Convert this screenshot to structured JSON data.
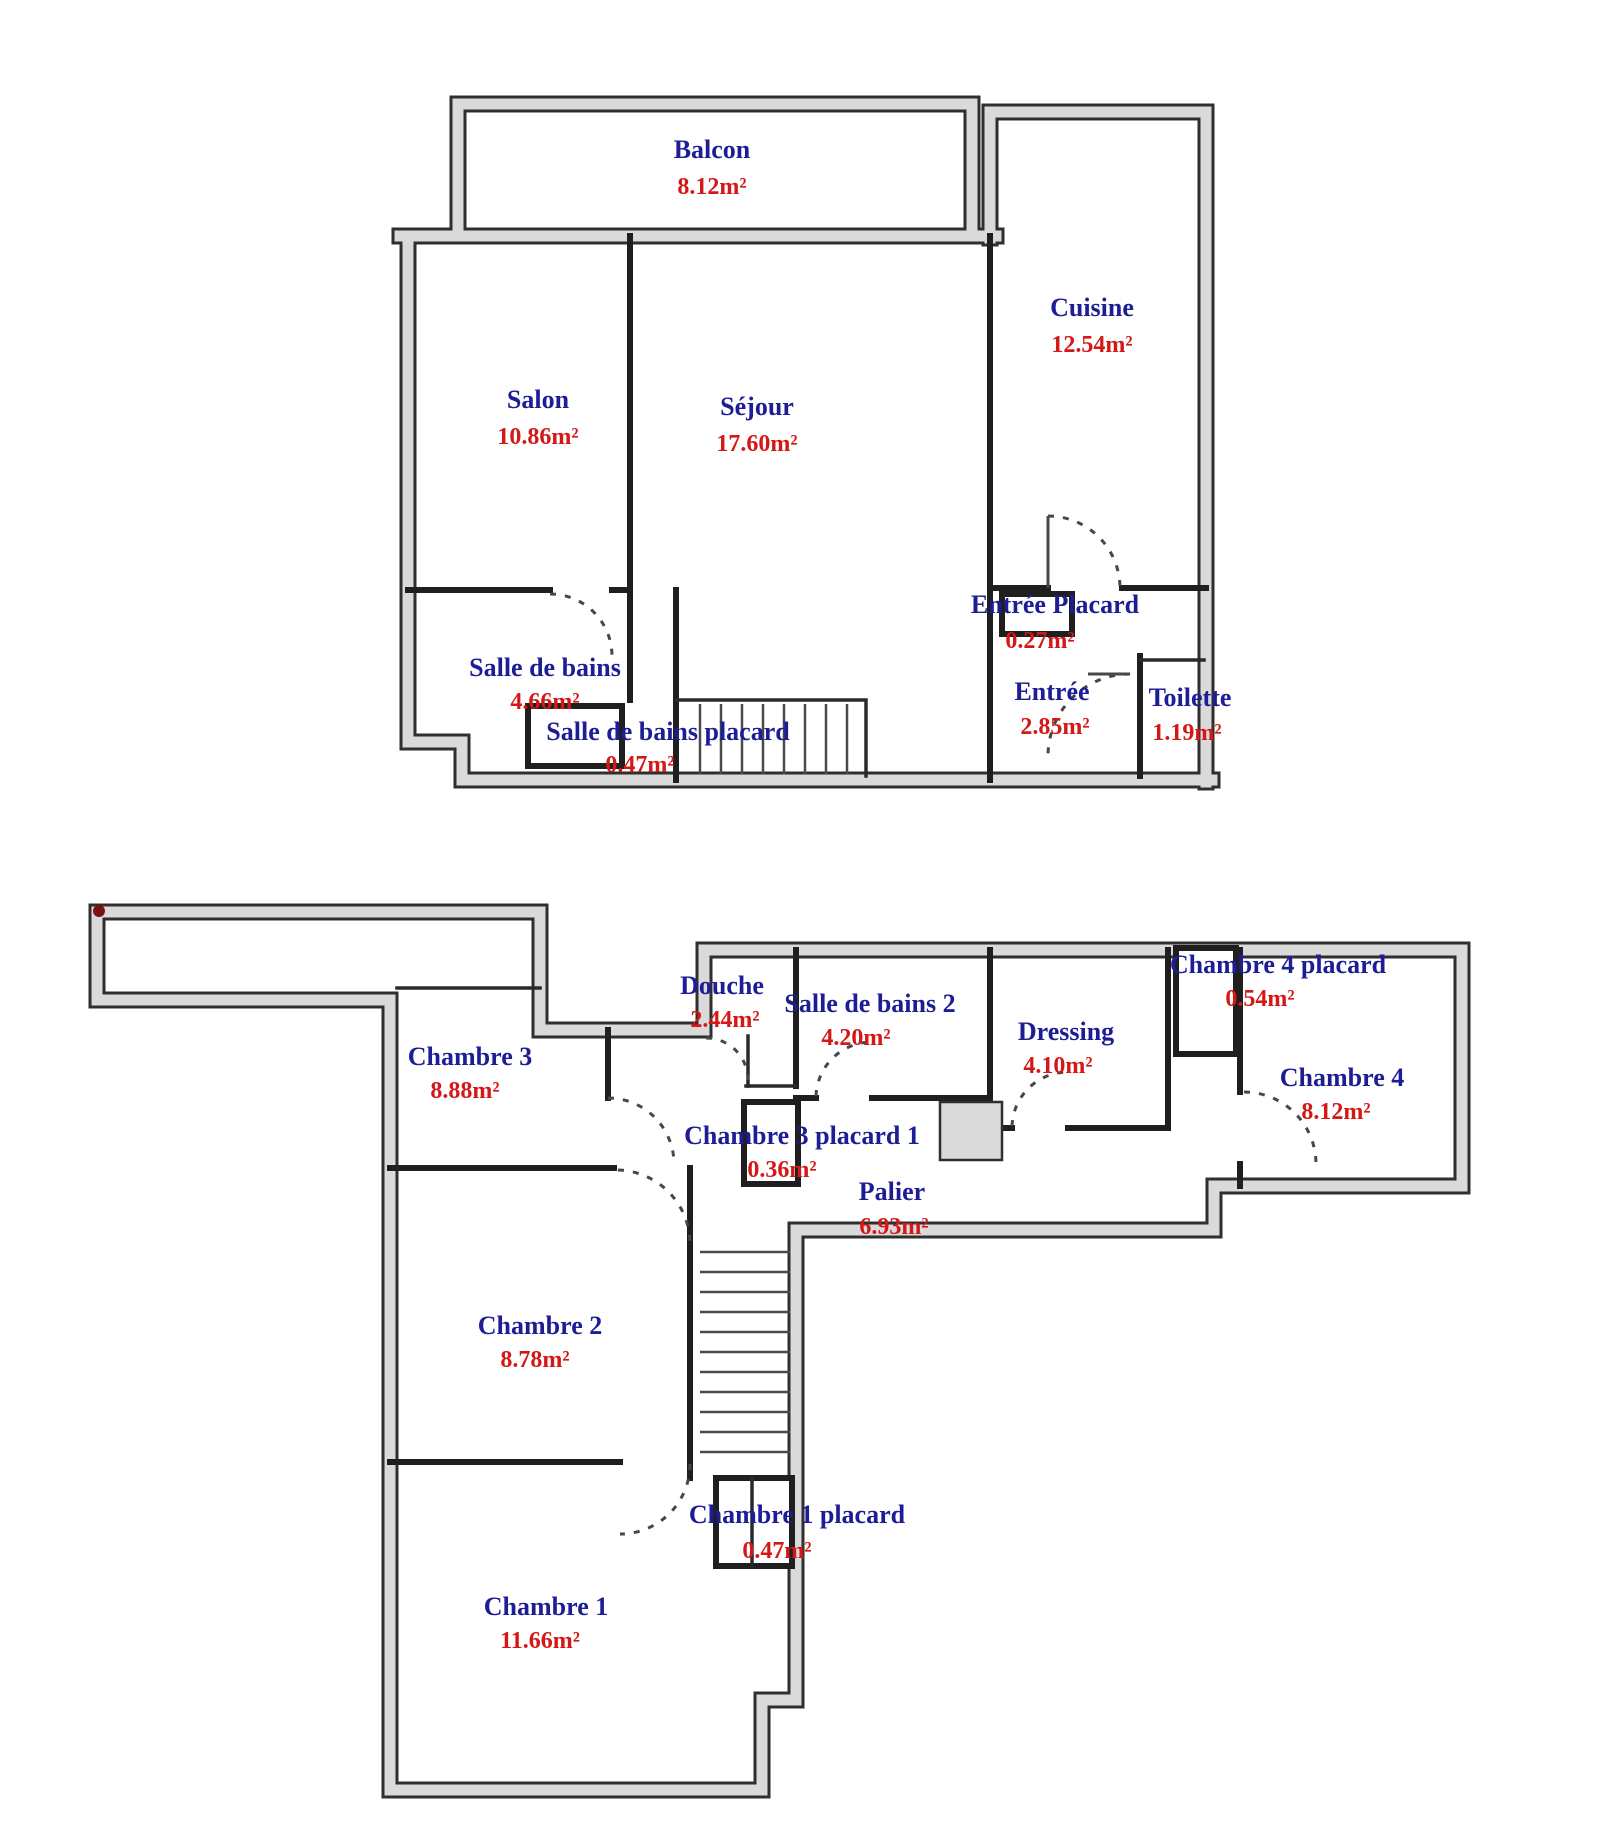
{
  "document": {
    "kind": "apartment floor plan (scanned)",
    "language": "French"
  },
  "colors": {
    "room_name_text": "#1d1d96",
    "room_area_text": "#d41717",
    "outer_wall_fill": "#dadada",
    "wall_line": "#1f1f1f",
    "background": "#ffffff",
    "corner_dot": "#7a1212"
  },
  "floors": {
    "upper": {
      "rooms": [
        {
          "name": "Balcon",
          "area": "8.12m²"
        },
        {
          "name": "Salon",
          "area": "10.86m²"
        },
        {
          "name": "Séjour",
          "area": "17.60m²"
        },
        {
          "name": "Cuisine",
          "area": "12.54m²"
        },
        {
          "name": "Salle de bains",
          "area": "4.66m²"
        },
        {
          "name": "Salle de bains placard",
          "area": "0.47m²"
        },
        {
          "name": "Entrée Placard",
          "area": "0.27m²"
        },
        {
          "name": "Entrée",
          "area": "2.85m²"
        },
        {
          "name": "Toilette",
          "area": "1.19m²"
        }
      ]
    },
    "lower": {
      "rooms": [
        {
          "name": "Chambre 3",
          "area": "8.88m²"
        },
        {
          "name": "Douche",
          "area": "2.44m²"
        },
        {
          "name": "Salle de bains 2",
          "area": "4.20m²"
        },
        {
          "name": "Dressing",
          "area": "4.10m²"
        },
        {
          "name": "Chambre 4 placard",
          "area": "0.54m²"
        },
        {
          "name": "Chambre 4",
          "area": "8.12m²"
        },
        {
          "name": "Chambre 3 placard 1",
          "area": "0.36m²"
        },
        {
          "name": "Palier",
          "area": "6.93m²"
        },
        {
          "name": "Chambre 2",
          "area": "8.78m²"
        },
        {
          "name": "Chambre 1 placard",
          "area": "0.47m²"
        },
        {
          "name": "Chambre 1",
          "area": "11.66m²"
        }
      ]
    }
  }
}
